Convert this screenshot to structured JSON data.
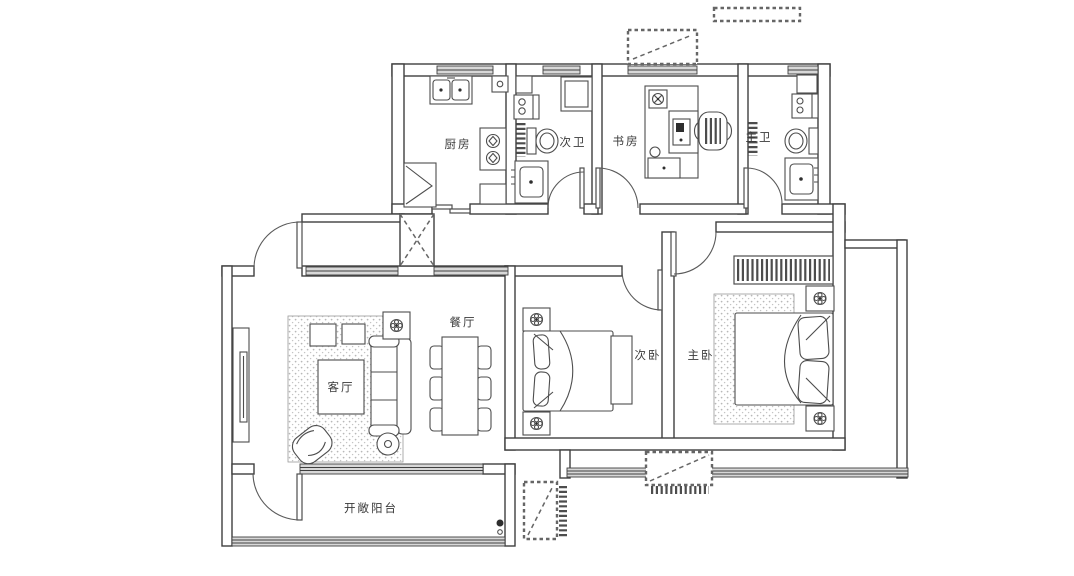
{
  "floorplan": {
    "rooms": {
      "kitchen": "厨房",
      "secondary_bath": "次卫",
      "study": "书房",
      "master_bath": "主卫",
      "dining": "餐厅",
      "living": "客厅",
      "secondary_bedroom": "次卧",
      "master_bedroom": "主卧",
      "balcony": "开敞阳台"
    },
    "colors": {
      "line": "#3f3f3f",
      "window_fill": "#d8d8d8",
      "background": "#ffffff"
    }
  }
}
